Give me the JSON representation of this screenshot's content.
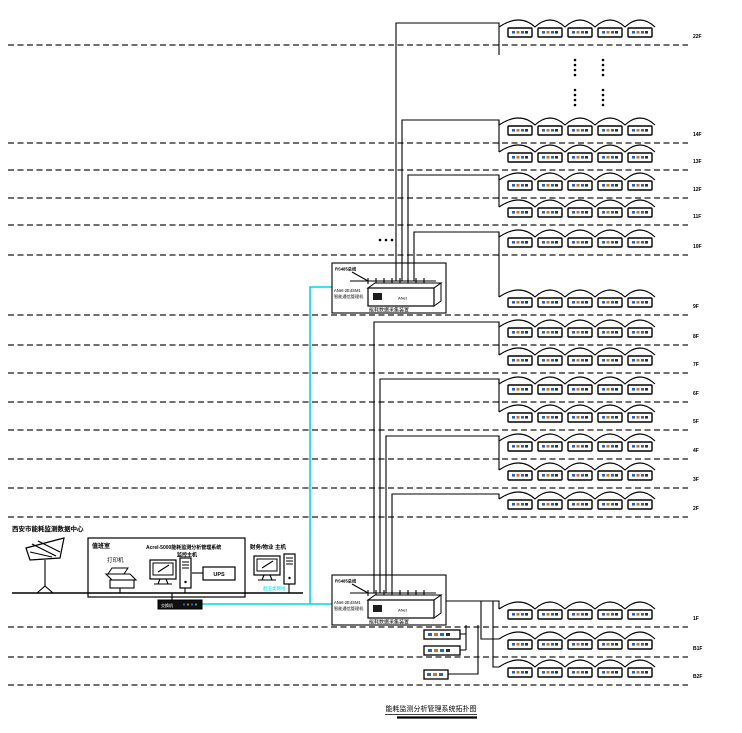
{
  "title": "能耗监测分析管理系统拓扑图",
  "data_center": {
    "label": "西安市能耗监测数据中心"
  },
  "duty_room": {
    "label": "值班室",
    "printer_label": "打印机",
    "host_line1": "Acrel-5000能耗监测分析管理系统",
    "host_line2": "监控主机",
    "ups_label": "UPS"
  },
  "finance_host_label": "财务/物业 主机",
  "network": {
    "switch_label": "交换机",
    "cable_label": "超五类网线",
    "cable_color": "#00d8e4"
  },
  "gateway": {
    "bus_label": "RS485总线",
    "model_line1": "ANet-2E4SM1",
    "model_line2": "智能通信管理机",
    "device_text": "ANet",
    "caption": "能耗数据采集装置"
  },
  "floors": [
    "22F",
    "14F",
    "13F",
    "12F",
    "11F",
    "10F",
    "9F",
    "8F",
    "7F",
    "6F",
    "5F",
    "4F",
    "3F",
    "2F",
    "1F",
    "B1F",
    "B2F"
  ],
  "meters_per_floor": 5,
  "colors": {
    "wire": "#000000",
    "separator": "#1a1a1a",
    "meter_mark_blue": "#2b5fd0",
    "meter_mark_orange": "#c9731f",
    "meter_mark_dark": "#24324a"
  }
}
